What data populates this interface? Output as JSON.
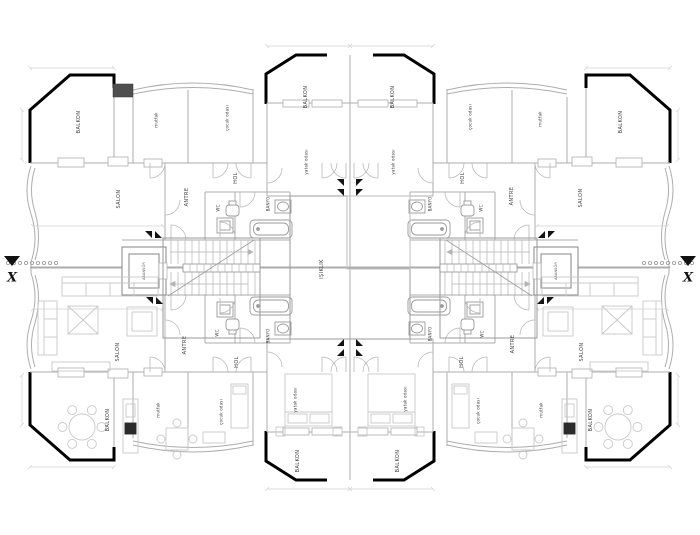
{
  "drawing": {
    "type": "architectural-floor-plan",
    "core": {
      "light_well": "IŞIKLIK",
      "elevator_left": "ASANSÖR",
      "elevator_right": "ASANSÖR"
    },
    "section_markers": {
      "left": "X",
      "right": "X"
    },
    "apartments": {
      "top_left": {
        "balkon_corner": "BALKON",
        "mutfak": "mutfak",
        "cocuk_odasi": "çocuk odası",
        "balkon_center": "BALKON",
        "yatak_odasi": "yatak odası",
        "salon": "SALON",
        "antre": "ANTRE",
        "hol": "HOL",
        "wc": "WC",
        "banyo": "BANYO"
      },
      "top_right": {
        "balkon_corner": "BALKON",
        "mutfak": "mutfak",
        "cocuk_odasi": "çocuk odası",
        "balkon_center": "BALKON",
        "yatak_odasi": "yatak odası",
        "salon": "SALON",
        "antre": "ANTRE",
        "hol": "HOL",
        "wc": "WC",
        "banyo": "BANYO"
      },
      "bottom_left": {
        "balkon_corner": "BALKON",
        "mutfak": "mutfak",
        "cocuk_odasi": "çocuk odası",
        "balkon_center": "BALKON",
        "yatak_odasi": "yatak odası",
        "salon": "SALON",
        "antre": "ANTRE",
        "hol": "HOL",
        "wc": "WC",
        "banyo": "BANYO"
      },
      "bottom_right": {
        "balkon_corner": "BALKON",
        "mutfak": "mutfak",
        "cocuk_odasi": "çocuk odası",
        "balkon_center": "BALKON",
        "yatak_odasi": "yatak odası",
        "salon": "SALON",
        "antre": "ANTRE",
        "hol": "HOL",
        "wc": "WC",
        "banyo": "BANYO"
      }
    },
    "colors": {
      "outer_wall": "#000000",
      "thin_line": "#adadad",
      "furniture_line": "#c9c9c9",
      "shaft_fill": "#4f4f4f",
      "label_text": "#3d3d3d"
    }
  }
}
